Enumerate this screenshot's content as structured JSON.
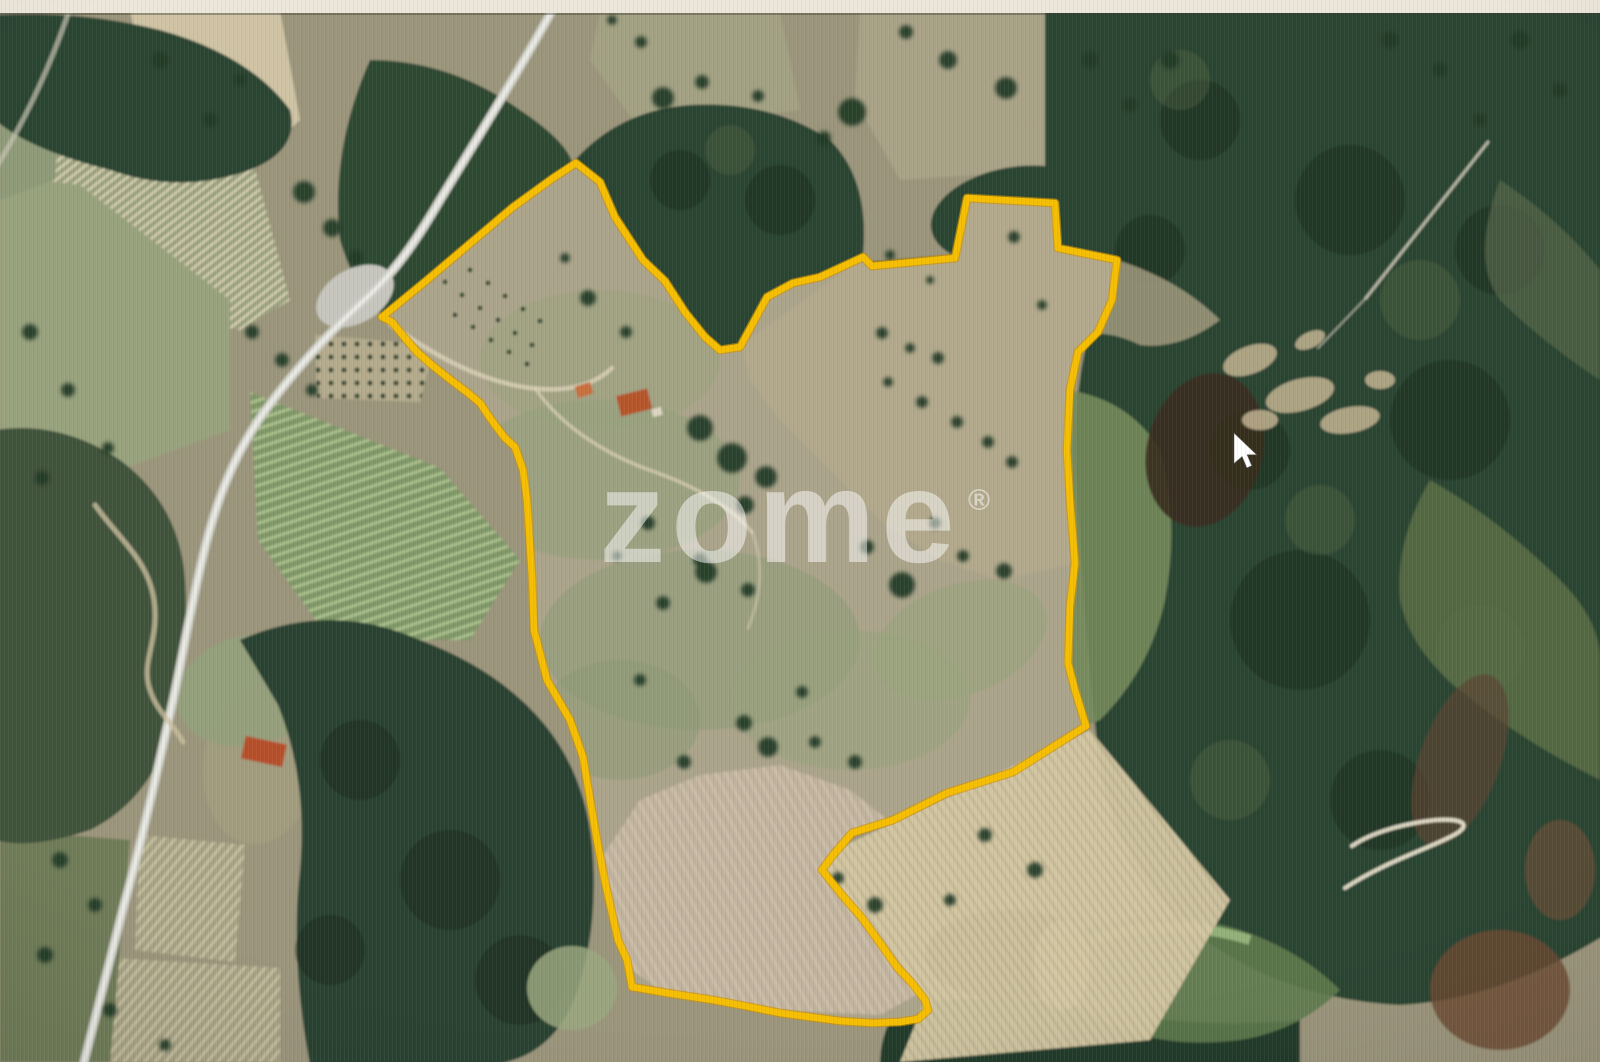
{
  "map": {
    "boundary": {
      "color": "#F6BE00",
      "points": "576,163 600,182 615,217 643,260 665,281 685,312 705,337 720,350 740,347 767,297 793,283 820,277 863,257 872,266 955,258 967,198 1055,203 1058,248 1117,260 1112,300 1098,332 1078,352 1070,390 1067,450 1070,500 1075,563 1070,607 1068,663 1075,690 1086,726 1013,772 947,793 893,820 852,833 833,855 822,870 842,895 862,918 880,943 897,967 912,983 925,1000 928,1010 918,1019 900,1022 872,1023 840,1021 810,1017 780,1013 745,1006 713,1000 667,993 632,987 627,960 618,940 605,882 597,840 588,787 583,757 570,720 547,680 534,630 532,577 527,500 523,470 515,447 505,438 495,425 488,415 480,403 468,393 452,381 433,366 417,352 404,337 392,322 382,317 427,280 513,207 553,178"
    },
    "watermark": {
      "text": "zome",
      "registered_mark": "®"
    },
    "cursor": {
      "transform": "translate(1234,433)"
    }
  }
}
